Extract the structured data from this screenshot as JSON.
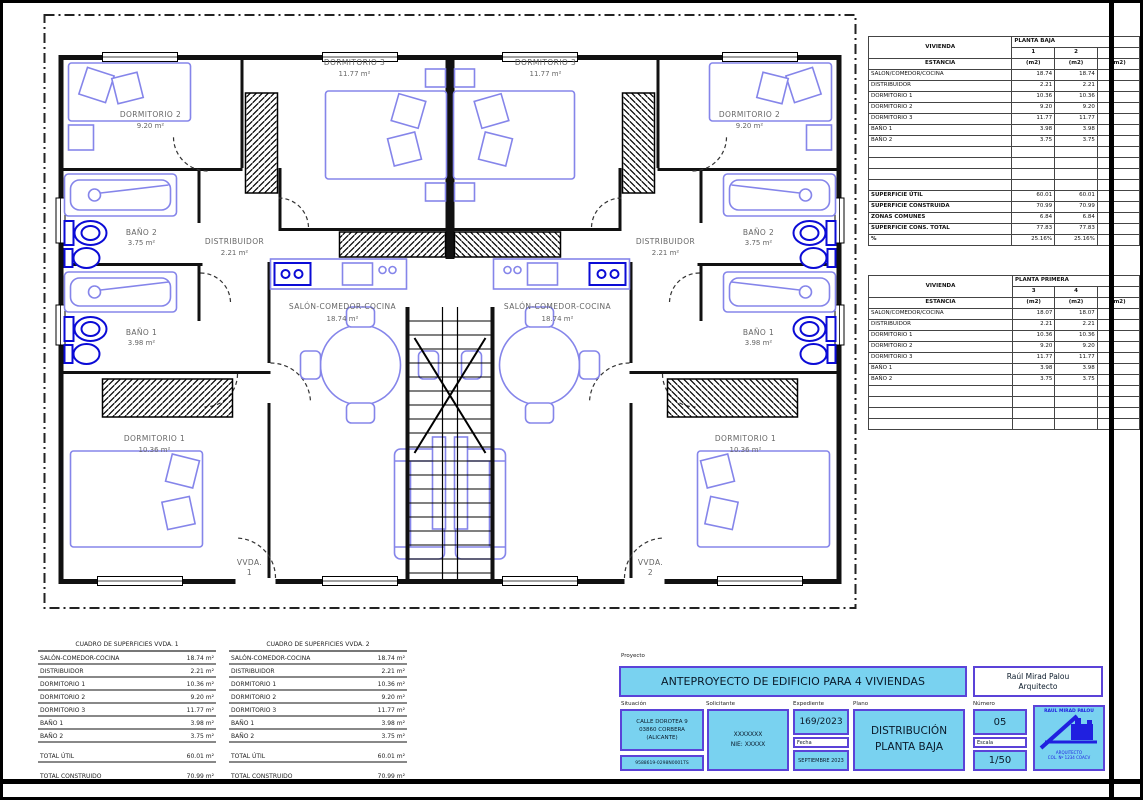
{
  "plan": {
    "rooms": {
      "salon": {
        "name": "SALÓN-COMEDOR-COCINA",
        "area": "18.74 m²"
      },
      "distribuidor": {
        "name": "DISTRIBUIDOR",
        "area": "2.21 m²"
      },
      "dorm1": {
        "name": "DORMITORIO 1",
        "area": "10.36 m²"
      },
      "dorm2": {
        "name": "DORMITORIO 2",
        "area": "9.20 m²"
      },
      "dorm3": {
        "name": "DORMITORIO 3",
        "area": "11.77 m²"
      },
      "banio1": {
        "name": "BAÑO 1",
        "area": "3.98 m²"
      },
      "banio2": {
        "name": "BAÑO 2",
        "area": "3.75 m²"
      }
    },
    "units": {
      "vvda1_line1": "VVDA.",
      "vvda1_line2": "1",
      "vvda2_line1": "VVDA.",
      "vvda2_line2": "2"
    }
  },
  "surface_tables": {
    "planta_baja": {
      "vivienda_label": "VIVIENDA",
      "estancia_label": "ESTANCIA",
      "floor_label": "PLANTA BAJA",
      "col1": "1",
      "col2": "2",
      "m2": "(m2)",
      "rows": [
        [
          "SALON/COMEDOR/COCINA",
          "18.74",
          "18.74"
        ],
        [
          "DISTRIBUIDOR",
          "2.21",
          "2.21"
        ],
        [
          "DORMITORIO 1",
          "10.36",
          "10.36"
        ],
        [
          "DORMITORIO 2",
          "9.20",
          "9.20"
        ],
        [
          "DORMITORIO 3",
          "11.77",
          "11.77"
        ],
        [
          "BAÑO 1",
          "3.98",
          "3.98"
        ],
        [
          "BAÑO 2",
          "3.75",
          "3.75"
        ]
      ],
      "summary": [
        [
          "SUPERFICIE ÚTIL",
          "60.01",
          "60.01"
        ],
        [
          "SUPERFICIE CONSTRUIDA",
          "70.99",
          "70.99"
        ],
        [
          "ZONAS COMUNES",
          "6.84",
          "6.84"
        ],
        [
          "SUPERFICIE CONS. TOTAL",
          "77.83",
          "77.83"
        ],
        [
          "%",
          "25.16%",
          "25.16%"
        ]
      ]
    },
    "planta_primera": {
      "vivienda_label": "VIVIENDA",
      "estancia_label": "ESTANCIA",
      "floor_label": "PLANTA PRIMERA",
      "col1": "3",
      "col2": "4",
      "m2": "(m2)",
      "rows": [
        [
          "SALON/COMEDOR/COCINA",
          "18.07",
          "18.07"
        ],
        [
          "DISTRIBUIDOR",
          "2.21",
          "2.21"
        ],
        [
          "DORMITORIO 1",
          "10.36",
          "10.36"
        ],
        [
          "DORMITORIO 2",
          "9.20",
          "9.20"
        ],
        [
          "DORMITORIO 3",
          "11.77",
          "11.77"
        ],
        [
          "BAÑO 1",
          "3.98",
          "3.98"
        ],
        [
          "BAÑO 2",
          "3.75",
          "3.75"
        ]
      ]
    }
  },
  "area_tables": [
    {
      "title": "CUADRO DE SUPERFICIES VVDA. 1",
      "rows": [
        [
          "SALÓN-COMEDOR-COCINA",
          "18.74 m²"
        ],
        [
          "DISTRIBUIDOR",
          "2.21 m²"
        ],
        [
          "DORMITORIO 1",
          "10.36 m²"
        ],
        [
          "DORMITORIO 2",
          "9.20 m²"
        ],
        [
          "DORMITORIO 3",
          "11.77 m²"
        ],
        [
          "BAÑO 1",
          "3.98 m²"
        ],
        [
          "BAÑO 2",
          "3.75 m²"
        ]
      ],
      "total_util_label": "TOTAL ÚTIL",
      "total_util": "60.01 m²",
      "total_cons_label": "TOTAL CONSTRUIDO",
      "total_cons": "70.99 m²"
    },
    {
      "title": "CUADRO DE SUPERFICIES VVDA. 2",
      "rows": [
        [
          "SALÓN-COMEDOR-COCINA",
          "18.74 m²"
        ],
        [
          "DISTRIBUIDOR",
          "2.21 m²"
        ],
        [
          "DORMITORIO 1",
          "10.36 m²"
        ],
        [
          "DORMITORIO 2",
          "9.20 m²"
        ],
        [
          "DORMITORIO 3",
          "11.77 m²"
        ],
        [
          "BAÑO 1",
          "3.98 m²"
        ],
        [
          "BAÑO 2",
          "3.75 m²"
        ]
      ],
      "total_util_label": "TOTAL ÚTIL",
      "total_util": "60.01 m²",
      "total_cons_label": "TOTAL CONSTRUIDO",
      "total_cons": "70.99 m²"
    }
  ],
  "title_block": {
    "proyecto_label": "Proyecto",
    "title": "ANTEPROYECTO DE EDIFICIO PARA 4 VIVIENDAS",
    "architect_name": "Raúl Mirad Palou",
    "architect_role": "Arquitecto",
    "situacion_label": "Situación",
    "situacion_lines": [
      "CALLE DOROTEA 9",
      "03860 CORBERA",
      "(ALICANTE)"
    ],
    "ref_catastral": "9588619-0298N0001TS",
    "solicitante_label": "Solicitante",
    "solicitante_lines": [
      "XXXXXXX",
      "NIE: XXXXX"
    ],
    "expediente_label": "Expediente",
    "expediente": "169/2023",
    "fecha_label": "Fecha",
    "fecha": "SEPTIEMBRE 2023",
    "plano_label": "Plano",
    "plano_lines": [
      "DISTRIBUCIÓN",
      "PLANTA BAJA"
    ],
    "numero_label": "Número",
    "numero": "05",
    "escala_label": "Escala",
    "escala": "1/50",
    "stamp_name": "RAUL MIRAD PALOU",
    "stamp_role": "ARQUITECTO",
    "stamp_col": "COL. Nº 1234 COACV"
  },
  "colors": {
    "cyan": "#79d2f0",
    "purple": "#5b43d8",
    "furniture": "#8585ea",
    "fixture": "#0b0bd6"
  }
}
